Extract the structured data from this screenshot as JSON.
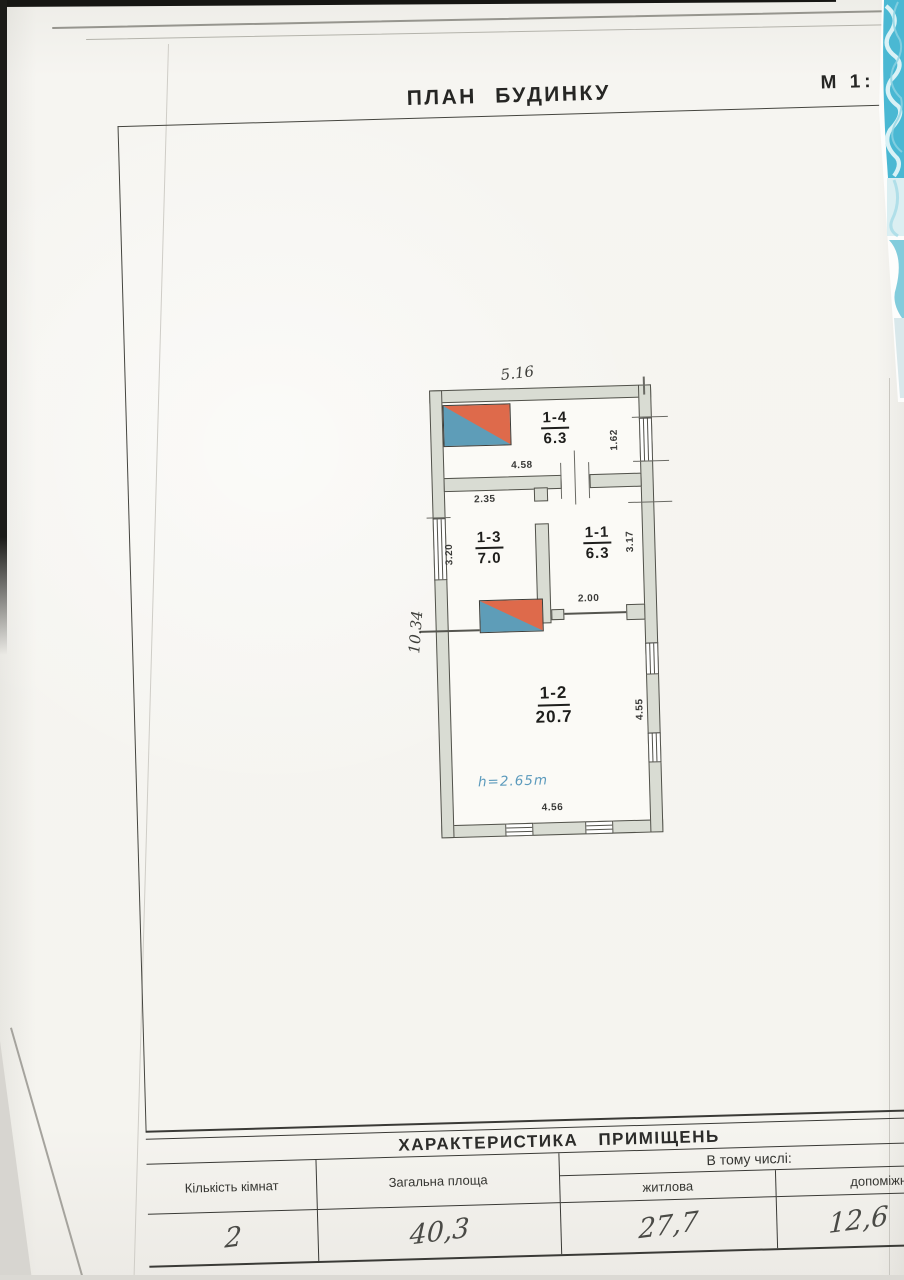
{
  "header": {
    "title": "ПЛАН БУДИНКУ",
    "scale": "М 1:"
  },
  "plan": {
    "rooms": [
      {
        "id": "1-4",
        "area": "6.3"
      },
      {
        "id": "1-3",
        "area": "7.0"
      },
      {
        "id": "1-1",
        "area": "6.3"
      },
      {
        "id": "1-2",
        "area": "20.7"
      }
    ],
    "height_note": "h=2.65m",
    "dims": {
      "overall_width": "5.16",
      "overall_height": "10.34",
      "win_right_top": "1.62",
      "top_wall_inner": "4.58",
      "room13_width": "2.35",
      "room13_height": "3.20",
      "room11_height": "3.17",
      "door_opening": "2.00",
      "room12_height": "4.55",
      "room12_width": "4.56"
    }
  },
  "table": {
    "title": "ХАРАКТЕРИСТИКА ПРИМІЩЕНЬ",
    "columns": {
      "rooms": "Кількість кімнат",
      "total": "Загальна площа",
      "including": "В тому числі:",
      "living": "житлова",
      "auxiliary": "допоміжн"
    },
    "values": {
      "rooms": "2",
      "total": "40,3",
      "living": "27,7",
      "auxiliary": "12,6"
    }
  },
  "colors": {
    "stairs_red": "#de6a4b",
    "stairs_blue": "#5e9db8",
    "wall_fill": "#d9dcd3",
    "pattern_teal": "#4ab8d3",
    "note_blue": "#5d9bbd"
  }
}
